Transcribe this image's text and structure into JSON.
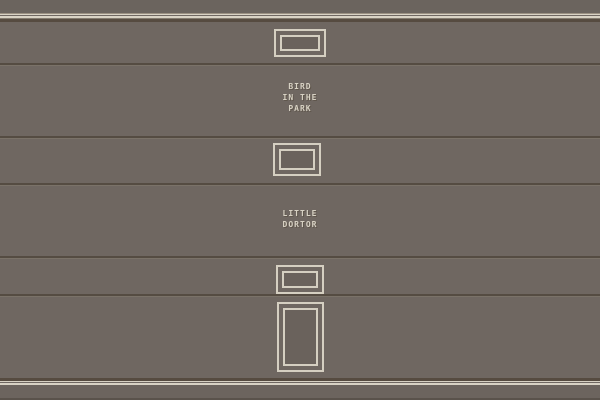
{
  "facade": {
    "signs": {
      "upper": {
        "lines": [
          "BIRD",
          "IN THE",
          "PARK"
        ]
      },
      "lower": {
        "lines": [
          "LITTLE",
          "DORTOR"
        ]
      }
    },
    "features": {
      "window_count": 3,
      "door_count": 1
    },
    "colors": {
      "wall": "#6f6761",
      "attic_wall": "#6b645e",
      "seam_dark": "#554c42",
      "seam_light": "#7a7268",
      "molding_dark": "#564b40",
      "trim_cream": "#d8d2c4",
      "trim_tan": "#9b9183",
      "frame_cream": "#d5cfc1",
      "window_fill": "#6a625c",
      "plinth": "#6c645e",
      "sign_text": "#d8d2c4"
    }
  }
}
